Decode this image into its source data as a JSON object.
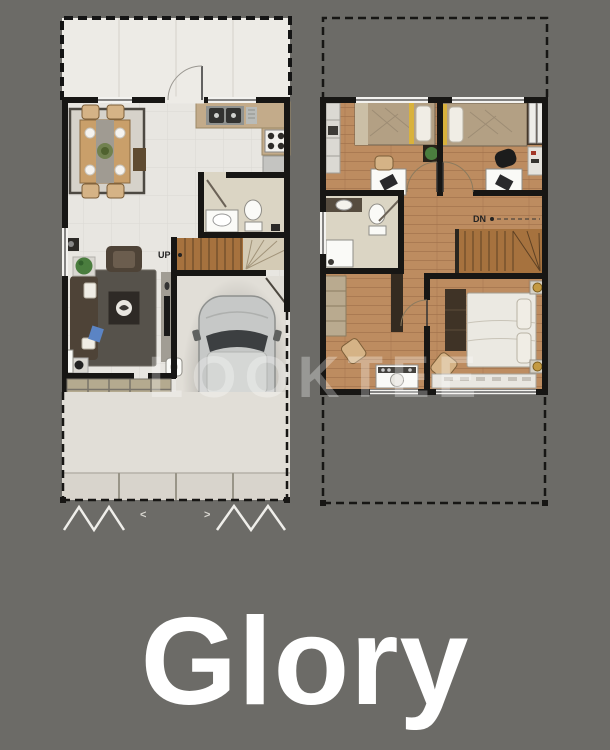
{
  "title": {
    "text": "Glory"
  },
  "watermark": {
    "text": "LOOKTEE"
  },
  "ground_floor": {
    "stairs_label": "UP",
    "gate_arrow_left": "<",
    "gate_arrow_right": ">"
  },
  "upper_floor": {
    "stairs_label": "DN"
  },
  "colors": {
    "background": "#6c6b67",
    "wall": "#171614",
    "tile_floor": "#e8e6e1",
    "terrace_floor": "#edebe6",
    "wood_floor": "#bd8c60",
    "stair_wood": "#a6723e",
    "counter_tan": "#c3ab8a",
    "rug_dark": "#56524b",
    "rug_light": "#d6d2ca",
    "sofa_dark": "#4e4337",
    "table_wood": "#c99f6a",
    "chair_tan": "#d5b386",
    "car_body": "#c6c8c7",
    "car_glass": "#3c3f41",
    "bed_tan": "#b3a084",
    "bed_white": "#ebe9e2",
    "pillow_white": "#f0ede5",
    "gold": "#c49a42",
    "plant_green": "#4a7d3e",
    "concrete": "#e1ded7",
    "paver_tan": "#b4aa8f",
    "bath_floor": "#dbd5c4",
    "fixture_white": "#fafaf7",
    "label_dark": "#232323",
    "gate_white": "#efeeea",
    "watermark_white": "#ffffff",
    "title_white": "#ffffff"
  }
}
